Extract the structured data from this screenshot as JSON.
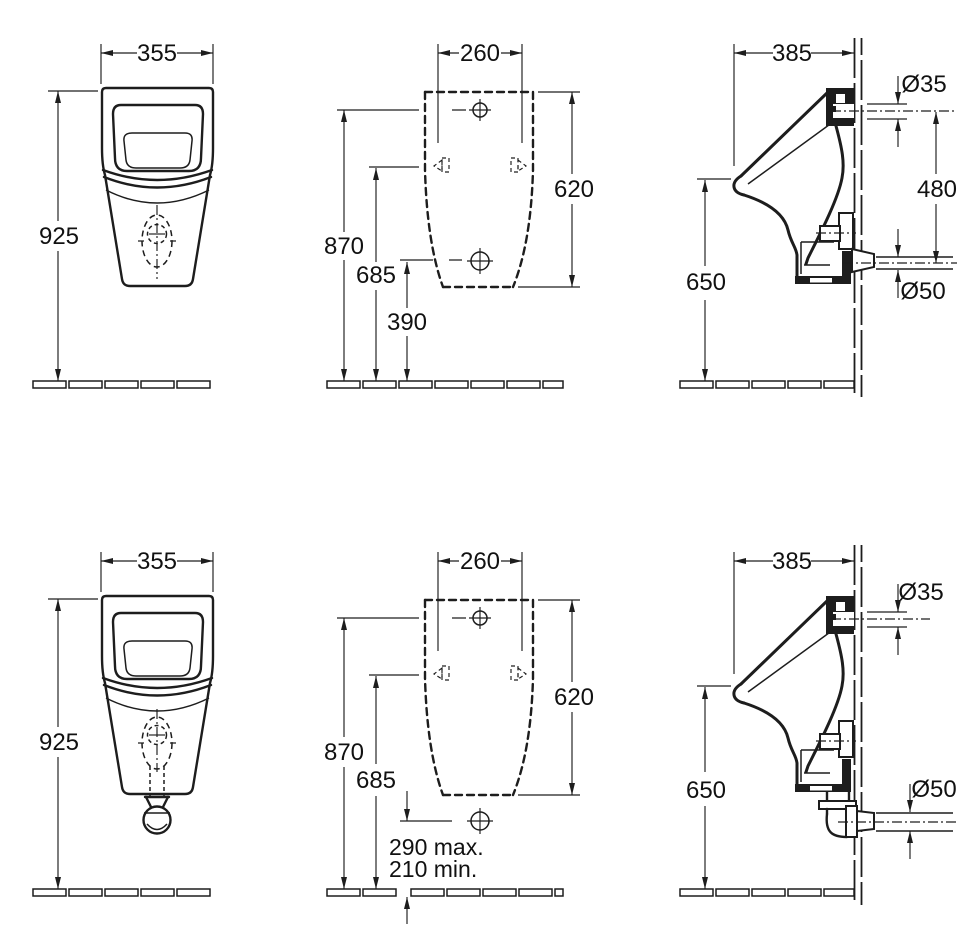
{
  "meta": {
    "background_color": "#ffffff",
    "line_color": "#1d1d1d",
    "description": "Technical dimension drawing: wall-hung urinal, two variants (concealed outlet / visible siphon), each with front view, mounting template and side section"
  },
  "views": {
    "front_top": {
      "width": "355",
      "height": "925"
    },
    "template_top": {
      "width": "260",
      "height": "620",
      "floor_to_top_hole": "870",
      "floor_to_brackets": "685",
      "floor_to_bottom_hole": "390"
    },
    "side_top": {
      "depth": "385",
      "inlet_diameter": "Ø35",
      "inlet_to_outlet": "480",
      "outlet_diameter": "Ø50",
      "floor_to_rim": "650"
    },
    "front_bottom": {
      "width": "355",
      "height": "925"
    },
    "template_bottom": {
      "width": "260",
      "height": "620",
      "floor_to_top_hole": "870",
      "floor_to_brackets": "685",
      "outlet_max": "290 max.",
      "outlet_min": "210 min."
    },
    "side_bottom": {
      "depth": "385",
      "inlet_diameter": "Ø35",
      "outlet_diameter": "Ø50",
      "floor_to_rim": "650"
    }
  }
}
